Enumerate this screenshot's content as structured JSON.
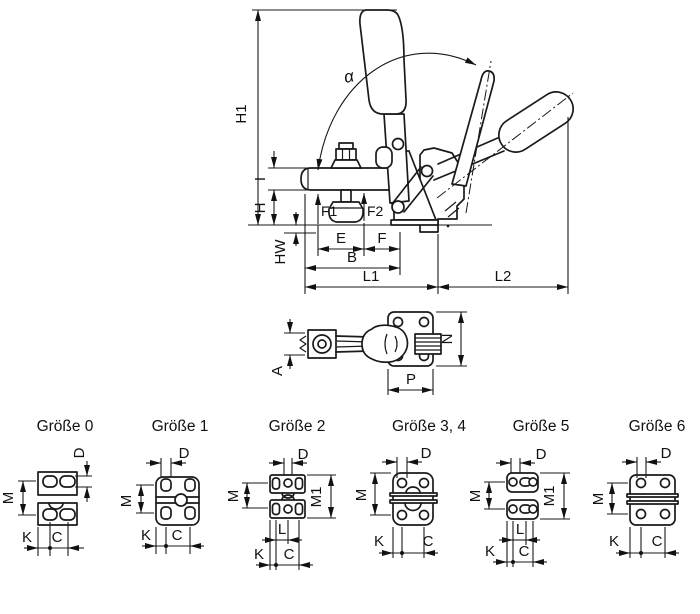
{
  "main_view": {
    "dims": {
      "h1": "H1",
      "i": "I",
      "h": "H",
      "hw": "HW",
      "f1": "F1",
      "f2": "F2",
      "e": "E",
      "f": "F",
      "b": "B",
      "l1": "L1",
      "l2": "L2",
      "alpha": "α"
    }
  },
  "top_view": {
    "dims": {
      "a": "A",
      "n": "N",
      "p": "P"
    }
  },
  "sizes": [
    {
      "title": "Größe 0",
      "dims": {
        "d": "D",
        "m": "M",
        "k": "K",
        "c": "C"
      }
    },
    {
      "title": "Größe 1",
      "dims": {
        "d": "D",
        "m": "M",
        "k": "K",
        "c": "C"
      }
    },
    {
      "title": "Größe 2",
      "dims": {
        "d": "D",
        "m": "M",
        "m1": "M1",
        "l": "L",
        "k": "K",
        "c": "C"
      }
    },
    {
      "title": "Größe 3, 4",
      "dims": {
        "d": "D",
        "m": "M",
        "k": "K",
        "c": "C"
      }
    },
    {
      "title": "Größe 5",
      "dims": {
        "d": "D",
        "m": "M",
        "m1": "M1",
        "l": "L",
        "k": "K",
        "c": "C"
      }
    },
    {
      "title": "Größe 6",
      "dims": {
        "d": "D",
        "m": "M",
        "k": "K",
        "c": "C"
      }
    }
  ],
  "colors": {
    "line": "#1a1a1a",
    "background": "#ffffff"
  }
}
